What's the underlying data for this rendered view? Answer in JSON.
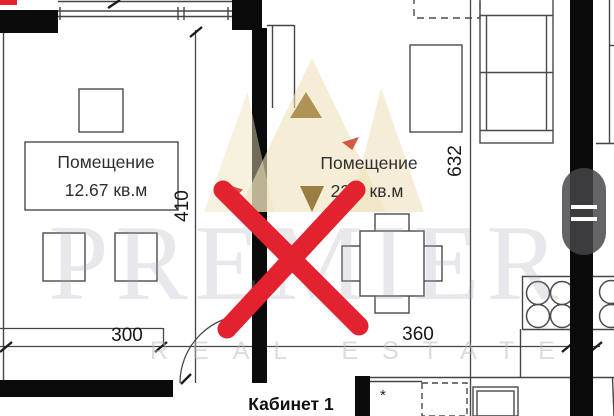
{
  "rooms": {
    "left": {
      "name": "Помещение",
      "area": "12.67 кв.м"
    },
    "right": {
      "name": "Помещение",
      "area": "22.7 кв.м"
    },
    "cabinet": {
      "name": "Кабинет 1"
    }
  },
  "dimensions": {
    "d300": "300",
    "d360": "360",
    "d410": "410",
    "d632": "632"
  },
  "marks": {
    "asterisk": "*"
  },
  "watermark": {
    "brand": "PREMIER",
    "tagline": "REAL ESTATE"
  },
  "colors": {
    "cross_red": "#e32230",
    "wall_black": "#0b0b0b",
    "line_gray": "#454545",
    "crown_gold": "#eee1ba",
    "handle_gray": "#46464a"
  }
}
